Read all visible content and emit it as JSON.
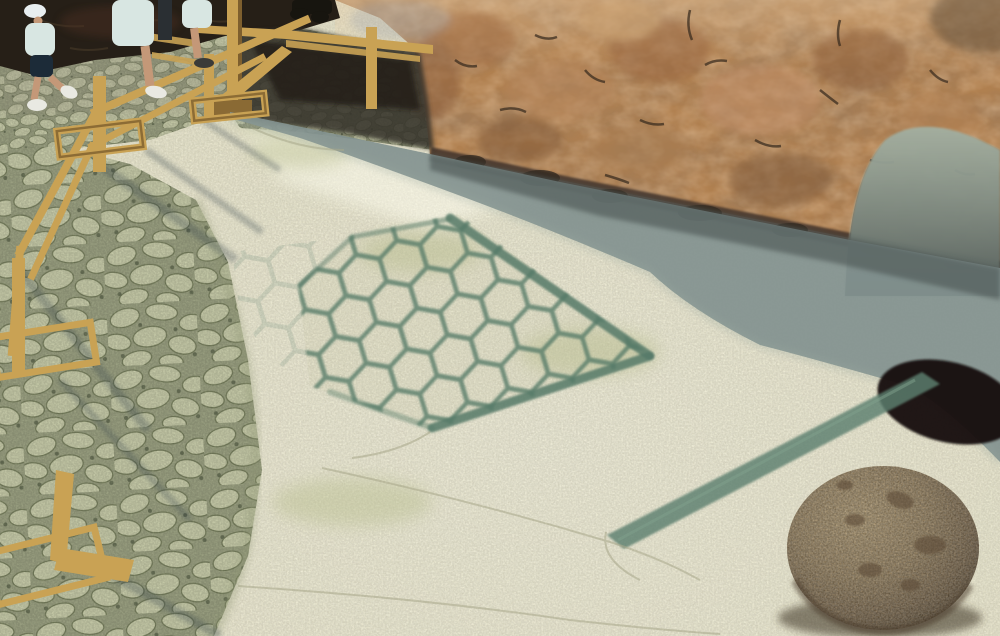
{
  "meta": {
    "title": "Archaeological site photograph",
    "description": "Sunlit excavated plaster floor bearing a hexagonal honeycomb mosaic outline, bounded above by a rough orange stone retaining wall in shadow, with a green tesserae channel band, a large round ballista-type stone at lower right, a cobbled visitor path with yellow wooden safety railings at left, and tourists walking at upper left."
  },
  "labels": {
    "scene": "Photograph of an excavated mosaic floor at an archaeological site",
    "wall": "Rough stone retaining wall",
    "plaster": "Light plastered patch of wall",
    "wall_shadow": "Shadow band cast along the wall base",
    "hole": "Dark opening at the wall base",
    "floor": "Sunlit excavated plaster floor",
    "mosaic": "Hexagonal honeycomb mosaic outline",
    "mosaic_border": "Dark green mosaic border lines",
    "band": "Green tesserae channel band crossing the floor",
    "stone": "Large round ballista-type stone",
    "cobbles": "Cobbled visitor path",
    "gravel": "Gravel walking area",
    "railing": "Yellow wooden safety railing with sled feet",
    "platform": "Wooden visitor walkway and stair",
    "rocks": "Dark rocky outcrop in shade",
    "visitor_child": "Child in white hat walking",
    "visitor_legs": "Walking visitor, legs visible",
    "visitor_partial": "Partially visible visitor",
    "platform_person": "Feet of person standing on walkway",
    "cracks": "Fine cracks in the floor plaster"
  },
  "colors": {
    "floor": "#ebe7c9",
    "floor_shadow": "#82918f",
    "shadow_deep": "#4c5452",
    "wall": "#b08050",
    "wall_dark": "#3f332a",
    "plaster": "#a3b0a2",
    "cobble": "#cdd1ae",
    "cobble_gap": "#a0a686",
    "mosaic_green": "#567a68",
    "band_green": "#5d8070",
    "wood": "#c9a254",
    "wood_dark": "#7e5f2e",
    "rock_dark": "#261f17",
    "stone_light": "#b49c72",
    "stone_dark": "#55452f",
    "hole": "#14110b",
    "shirt": "#d8e6e2",
    "shorts": "#1c2b38",
    "skin": "#c49878",
    "hat": "#e8eef0",
    "shoe": "#e9e9e2"
  }
}
